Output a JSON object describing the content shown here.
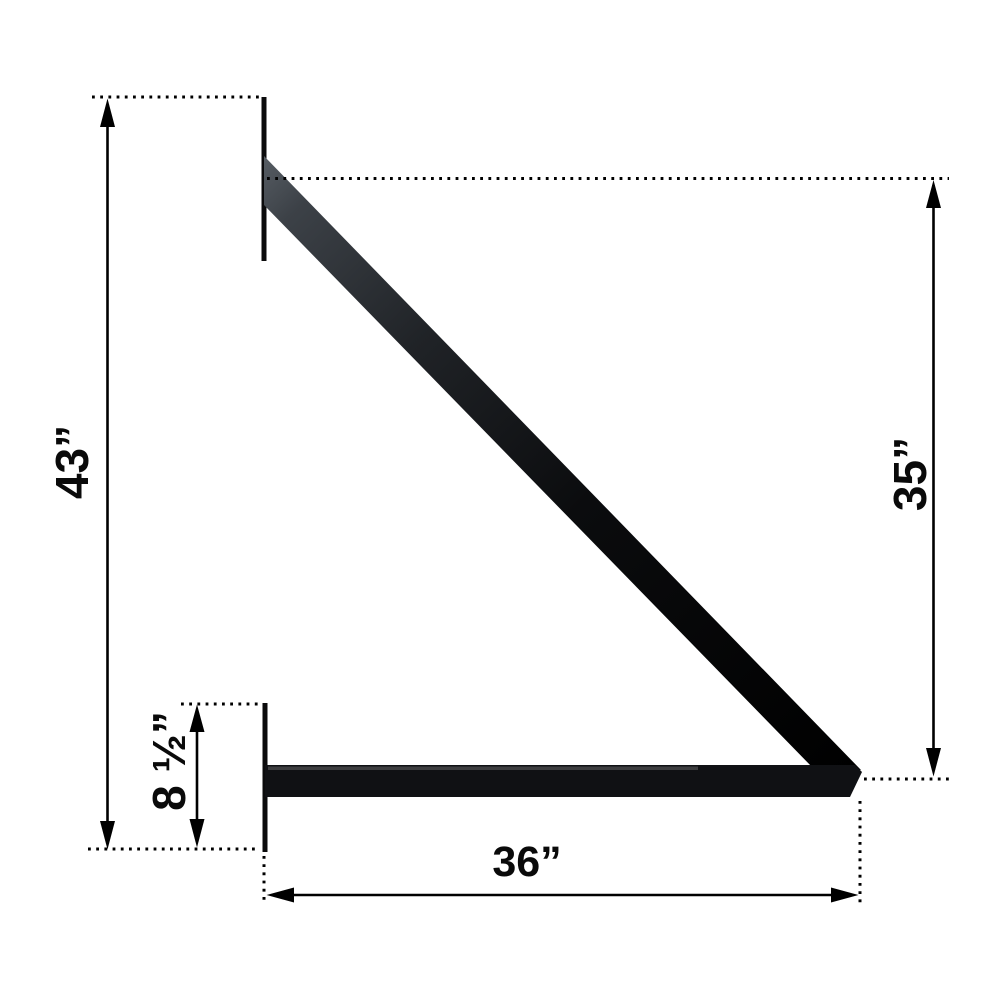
{
  "figure": {
    "type": "technical-dimension-diagram",
    "subject": "wall-mounted support bracket, side view",
    "background_color": "#ffffff",
    "line_color": "#000000",
    "bracket_fill_color": "#0d0e10",
    "brace_highlight_color": "#4a5057"
  },
  "dimensions": {
    "overall_height": {
      "label": "43”",
      "value": 43,
      "unit": "in",
      "orientation": "vertical",
      "position": "left"
    },
    "brace_drop": {
      "label": "35”",
      "value": 35,
      "unit": "in",
      "orientation": "vertical",
      "position": "right"
    },
    "arm_length": {
      "label": "36”",
      "value": 36,
      "unit": "in",
      "orientation": "horizontal",
      "position": "bottom"
    },
    "wall_plate_height": {
      "label": "8 ½”",
      "value": 8.5,
      "unit": "in",
      "orientation": "vertical",
      "position": "lower-left"
    }
  }
}
